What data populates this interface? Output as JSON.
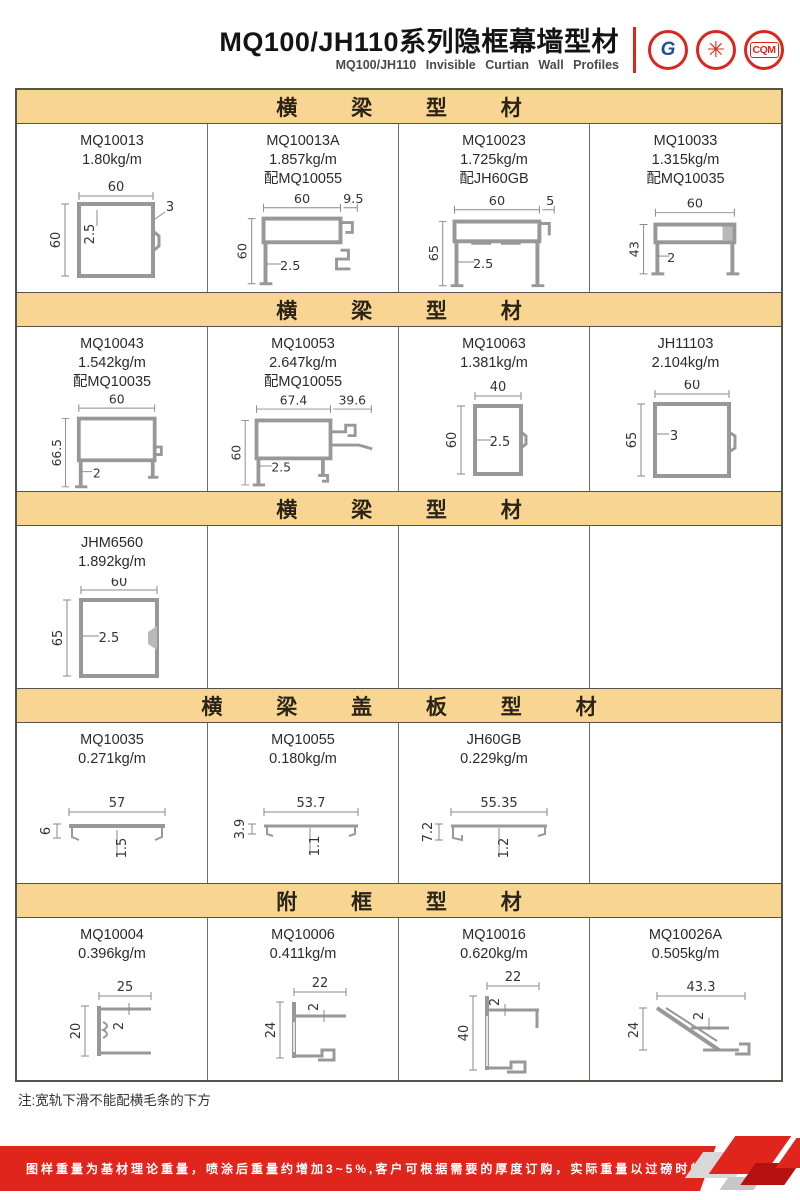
{
  "header": {
    "title": "MQ100/JH110系列隐框幕墙型材",
    "subtitle": "MQ100/JH110 Invisible Curtian Wall Profiles",
    "logos": [
      {
        "name": "gb-certification-logo",
        "glyph": "G"
      },
      {
        "name": "quality-seal-logo",
        "glyph": "✳"
      },
      {
        "name": "cqm-certification-logo",
        "glyph": "CQM"
      }
    ]
  },
  "sections": [
    {
      "title": "横 梁 型 材",
      "cells": [
        {
          "code": "MQ10013",
          "weight": "1.80kg/m",
          "match": "",
          "dims": [
            "60",
            "60",
            "2.5",
            "3"
          ]
        },
        {
          "code": "MQ10013A",
          "weight": "1.857kg/m",
          "match": "配MQ10055",
          "dims": [
            "60",
            "9.5",
            "60",
            "2.5"
          ]
        },
        {
          "code": "MQ10023",
          "weight": "1.725kg/m",
          "match": "配JH60GB",
          "dims": [
            "60",
            "5",
            "65",
            "2.5"
          ]
        },
        {
          "code": "MQ10033",
          "weight": "1.315kg/m",
          "match": "配MQ10035",
          "dims": [
            "60",
            "43",
            "2"
          ]
        }
      ]
    },
    {
      "title": "横 梁 型 材",
      "cells": [
        {
          "code": "MQ10043",
          "weight": "1.542kg/m",
          "match": "配MQ10035",
          "dims": [
            "60",
            "66.5",
            "2"
          ]
        },
        {
          "code": "MQ10053",
          "weight": "2.647kg/m",
          "match": "配MQ10055",
          "dims": [
            "67.4",
            "39.6",
            "60",
            "2.5"
          ]
        },
        {
          "code": "MQ10063",
          "weight": "1.381kg/m",
          "match": "",
          "dims": [
            "40",
            "60",
            "2.5"
          ]
        },
        {
          "code": "JH11103",
          "weight": "2.104kg/m",
          "match": "",
          "dims": [
            "60",
            "65",
            "3"
          ]
        }
      ]
    },
    {
      "title": "横 梁 型 材",
      "cells": [
        {
          "code": "JHM6560",
          "weight": "1.892kg/m",
          "match": "",
          "dims": [
            "60",
            "65",
            "2.5"
          ]
        }
      ]
    },
    {
      "title": "横 梁 盖 板 型 材",
      "cells": [
        {
          "code": "MQ10035",
          "weight": "0.271kg/m",
          "match": "",
          "dims": [
            "57",
            "6",
            "1.5"
          ]
        },
        {
          "code": "MQ10055",
          "weight": "0.180kg/m",
          "match": "",
          "dims": [
            "53.7",
            "3.9",
            "1.1"
          ]
        },
        {
          "code": "JH60GB",
          "weight": "0.229kg/m",
          "match": "",
          "dims": [
            "55.35",
            "7.2",
            "1.2"
          ]
        }
      ]
    },
    {
      "title": "附 框 型 材",
      "cells": [
        {
          "code": "MQ10004",
          "weight": "0.396kg/m",
          "match": "",
          "dims": [
            "25",
            "20",
            "2"
          ]
        },
        {
          "code": "MQ10006",
          "weight": "0.411kg/m",
          "match": "",
          "dims": [
            "22",
            "24",
            "2"
          ]
        },
        {
          "code": "MQ10016",
          "weight": "0.620kg/m",
          "match": "",
          "dims": [
            "22",
            "40",
            "2"
          ]
        },
        {
          "code": "MQ10026A",
          "weight": "0.505kg/m",
          "match": "",
          "dims": [
            "43.3",
            "24",
            "2"
          ]
        }
      ]
    }
  ],
  "note": "注:宽轨下滑不能配横毛条的下方",
  "footer": {
    "text": "图样重量为基材理论重量，喷涂后重量约增加3~5%,客户可根据需要的厚度订购，实际重量以过磅时的重量为准。",
    "brand_line1": "JIAHUA",
    "brand_line2": "ALUMINIUM",
    "page": "29"
  },
  "colors": {
    "accent_red": "#E0251D",
    "section_band": "#F8D593",
    "drawing_gray": "#98989a"
  }
}
